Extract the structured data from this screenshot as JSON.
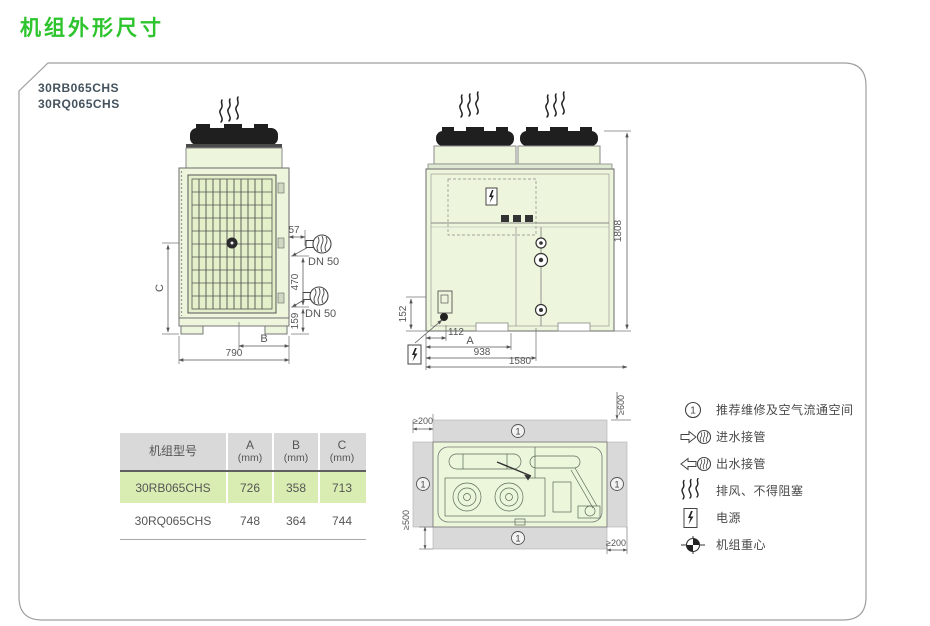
{
  "title": "机组外形尺寸",
  "models": {
    "line1": "30RB065CHS",
    "line2": "30RQ065CHS"
  },
  "colors": {
    "title_green": "#2ec42e",
    "unit_fill": "#edf6dc",
    "grille_fill": "#e3f0c9",
    "clearance_gray": "#d9d9d9",
    "table_header_bg": "#d9d9d9",
    "row_highlight": "#d9edb2"
  },
  "side_view": {
    "dim_57": "57",
    "dn50_top": "DN 50",
    "dn50_bottom": "DN 50",
    "dim_470": "470",
    "dim_159": "159",
    "dim_c": "C",
    "dim_b": "B",
    "dim_790": "790"
  },
  "front_view": {
    "dim_1808": "1808",
    "dim_152": "152",
    "dim_112": "112",
    "dim_a": "A",
    "dim_938": "938",
    "dim_1580": "1580"
  },
  "top_view": {
    "clear_top_left": "≥200",
    "clear_top_right": "≥600",
    "clear_bottom_left": "≥500",
    "clear_bottom_right": "≥200",
    "zone_mark": "1"
  },
  "legend": {
    "items": [
      {
        "symbol": "1",
        "label": "推荐维修及空气流通空间"
      },
      {
        "label": "进水接管"
      },
      {
        "label": "出水接管"
      },
      {
        "label": "排风、不得阻塞"
      },
      {
        "label": "电源"
      },
      {
        "label": "机组重心"
      }
    ]
  },
  "table": {
    "headers": {
      "model": "机组型号",
      "a1": "A",
      "a2": "(mm)",
      "b1": "B",
      "b2": "(mm)",
      "c1": "C",
      "c2": "(mm)"
    },
    "rows": [
      {
        "model": "30RB065CHS",
        "a": "726",
        "b": "358",
        "c": "713"
      },
      {
        "model": "30RQ065CHS",
        "a": "748",
        "b": "364",
        "c": "744"
      }
    ]
  }
}
